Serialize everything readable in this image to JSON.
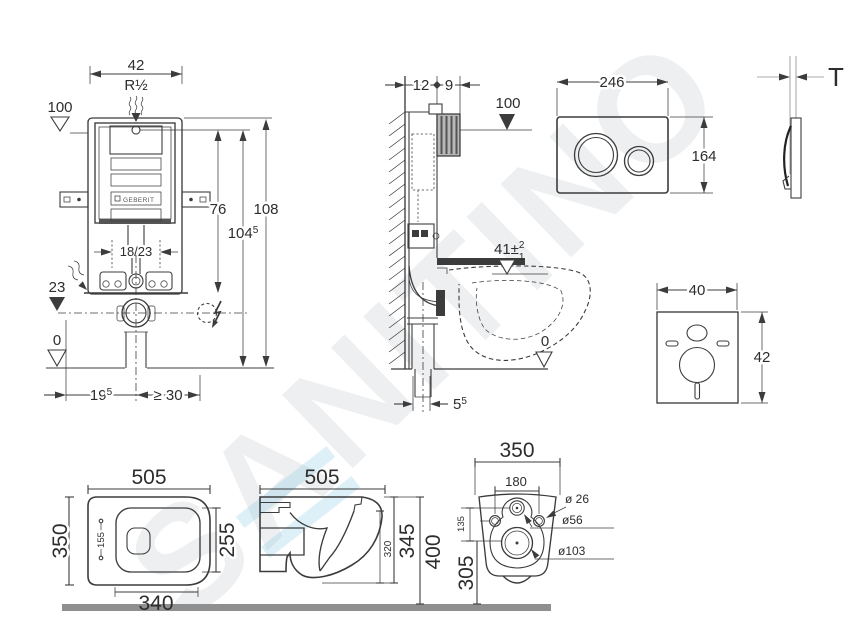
{
  "watermark": {
    "text": "SANITINO"
  },
  "cistern_front": {
    "width": "42",
    "thread": "R½",
    "level_top": "100",
    "h76": "76",
    "h108": "108",
    "h104_base": "104",
    "h104_sup": "5",
    "feet_offset": "18/23",
    "level_base": "23",
    "level_floor": "0",
    "d19_base": "19",
    "d19_sup": "5",
    "d_min30": "≥ 30",
    "brand": "GEBERIT"
  },
  "cistern_side": {
    "d12": "12",
    "d9": "9",
    "level_top": "100",
    "pan_level": "41±",
    "tol_sup": "2",
    "tol_sub": "1",
    "level_floor": "0",
    "d5_base": "5",
    "d5_sup": "5"
  },
  "flush_plate": {
    "width": "246",
    "height": "164",
    "thickness": "T"
  },
  "insulation_pad": {
    "width": "40",
    "height": "42"
  },
  "pan_top": {
    "width": "505",
    "depth": "350",
    "inner": "155",
    "rim": "255",
    "seat": "340"
  },
  "pan_side": {
    "width": "505",
    "h_rim": "320",
    "h_body": "345",
    "h_total": "400"
  },
  "pan_back": {
    "width": "350",
    "hole_span": "180",
    "v135": "135",
    "v305": "305",
    "dia26": "ø 26",
    "dia56": "ø56",
    "dia103": "ø103"
  }
}
